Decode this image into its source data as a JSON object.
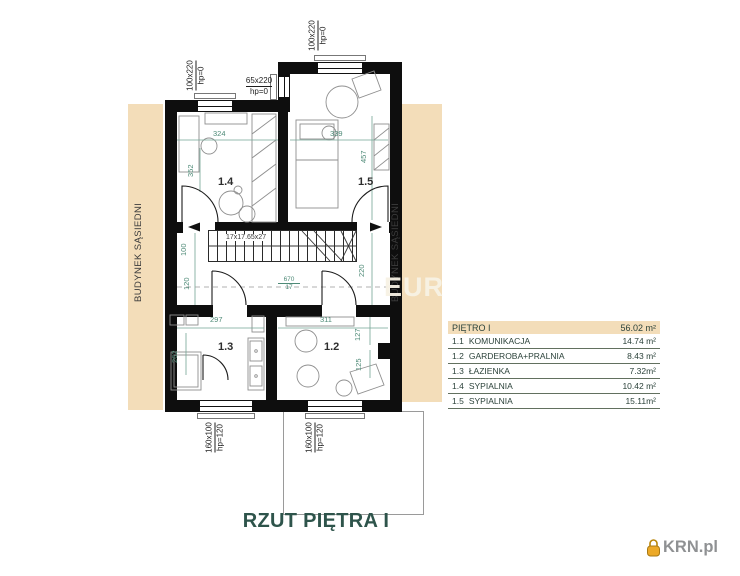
{
  "title": "RZUT PIĘTRA I",
  "watermark": "EUR",
  "logo": {
    "text": "KRN.pl"
  },
  "neighbor_left": "BUDYNEK SĄSIEDNI",
  "neighbor_right": "BUDYNEK SĄSIEDNI",
  "rooms": {
    "r14": "1.4",
    "r15": "1.5",
    "r13": "1.3",
    "r12": "1.2"
  },
  "stairs": {
    "label": "17x17.65x27"
  },
  "windows": {
    "top_left": {
      "size": "100x220",
      "hp": "hp=0"
    },
    "top_right": {
      "size": "100x220",
      "hp": "hp=0"
    },
    "step": {
      "size": "65x220",
      "hp": "hp=0"
    },
    "bottom_left": {
      "size": "160x100",
      "hp": "hp=120"
    },
    "bottom_right": {
      "size": "160x100",
      "hp": "hp=120"
    }
  },
  "dims": {
    "d324": "324",
    "d339": "339",
    "d457": "457",
    "d352": "352",
    "d100": "100",
    "d120": "120",
    "d220": "220",
    "d670": "670",
    "d17": "17",
    "d297": "297",
    "d262": "262",
    "d311": "311",
    "d127": "127",
    "d125": "125"
  },
  "legend": {
    "header": {
      "label": "PIĘTRO I",
      "area": "56.02 m²"
    },
    "rows": [
      {
        "num": "1.1",
        "name": "KOMUNIKACJA",
        "area": "14.74 m²"
      },
      {
        "num": "1.2",
        "name": "GARDEROBA+PRALNIA",
        "area": "8.43 m²"
      },
      {
        "num": "1.3",
        "name": "ŁAZIENKA",
        "area": "7.32m²"
      },
      {
        "num": "1.4",
        "name": "SYPIALNIA",
        "area": "10.42 m²"
      },
      {
        "num": "1.5",
        "name": "SYPIALNIA",
        "area": "15.11m²"
      }
    ]
  },
  "colors": {
    "beige": "#f3ddb9",
    "dim_green": "#4e8a77",
    "teal": "#2e544b",
    "logo_orange": "#eca927"
  }
}
